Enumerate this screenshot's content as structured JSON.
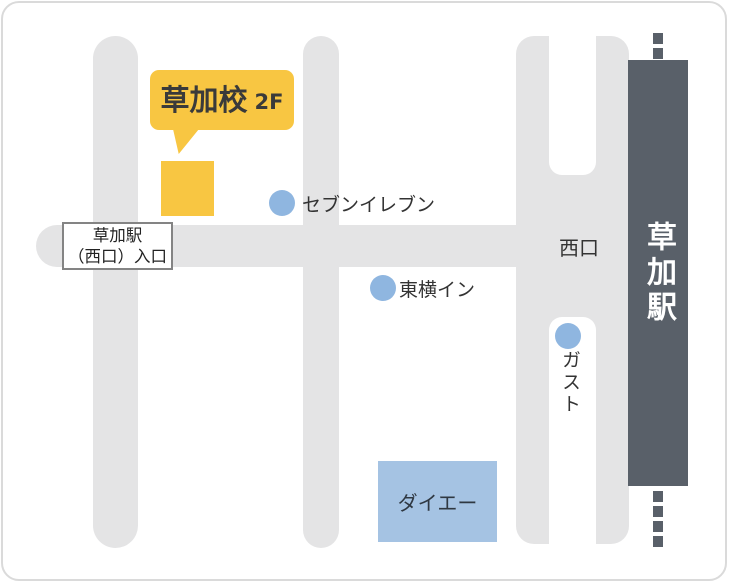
{
  "map": {
    "title": "access-map",
    "school": {
      "name": "草加校",
      "floor": "2F"
    },
    "entrance_sign": {
      "line1": "草加駅",
      "line2": "（西口）入口"
    },
    "station": {
      "name": "草加駅",
      "exit_label": "西口"
    },
    "landmarks": [
      {
        "id": "seven-eleven",
        "label": "セブンイレブン",
        "marker": "blue-dot"
      },
      {
        "id": "toyoko-inn",
        "label": "東横イン",
        "marker": "blue-dot"
      },
      {
        "id": "gusto",
        "label": "ガスト",
        "marker": "blue-dot",
        "orientation": "vertical"
      },
      {
        "id": "daiei",
        "label": "ダイエー",
        "marker": "blue-rect"
      }
    ],
    "colors": {
      "road_gray": "#e4e4e5",
      "station_dark": "#596069",
      "school_yellow": "#f8c642",
      "landmark_blue": "#8fb6e0",
      "daiei_blue": "#a5c3e3",
      "card_border": "#dadada"
    }
  }
}
